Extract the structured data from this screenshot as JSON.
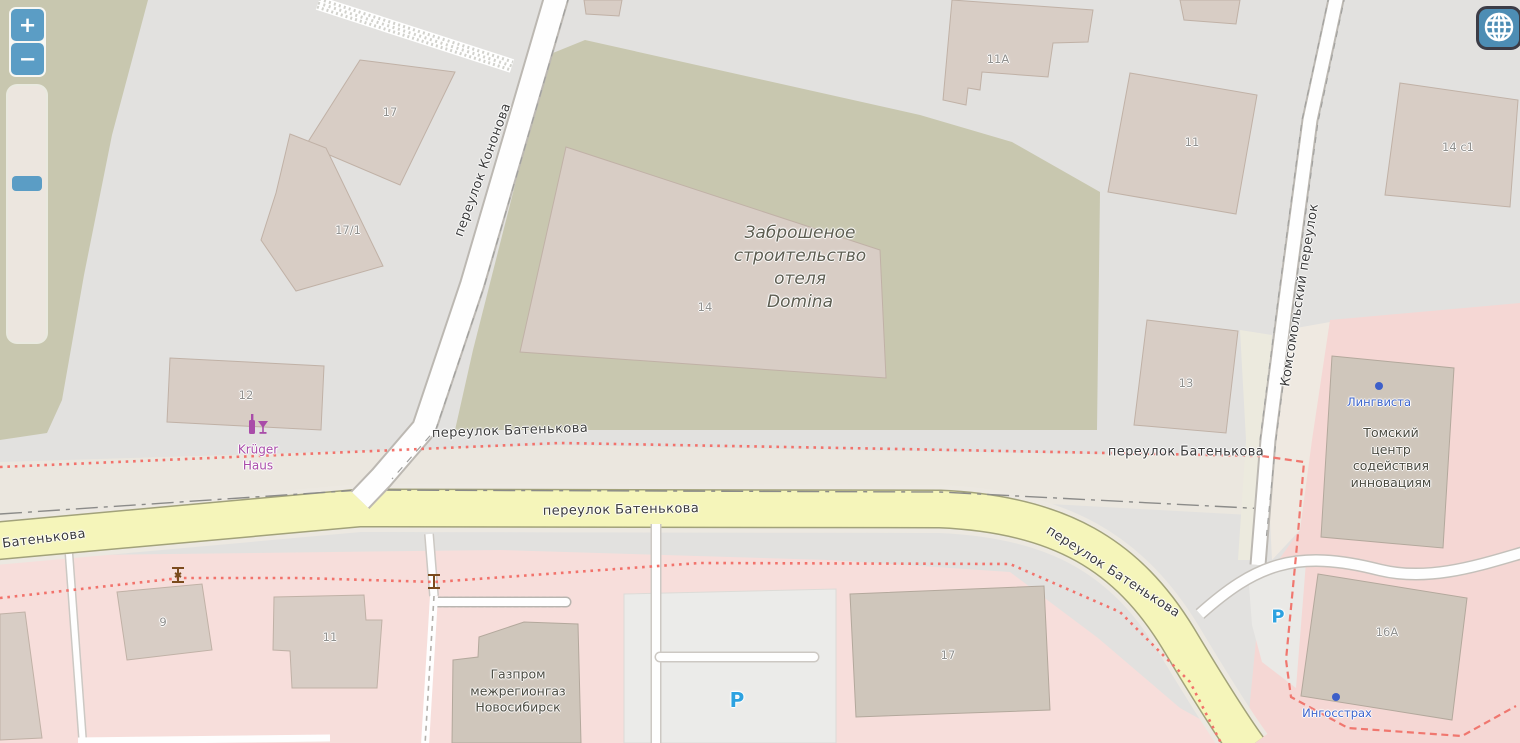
{
  "controls": {
    "zoom_in": "+",
    "zoom_out": "−"
  },
  "streets": {
    "kononova": "переулок Кононова",
    "komsomolsky": "Комсомольский переулок",
    "batenkova": "переулок Батенькова",
    "batenkova_short": "Батенькова"
  },
  "areas": {
    "abandoned": {
      "l1": "Заброшеное",
      "l2": "строительство",
      "l3": "отеля",
      "l4": "Domina"
    }
  },
  "buildings": {
    "b17_top": "17",
    "b17_1": "17/1",
    "b12": "12",
    "b14": "14",
    "b11a": "11A",
    "b11_top": "11",
    "b14c1": "14 c1",
    "b13": "13",
    "b16a": "16A",
    "b9": "9",
    "b11_bottom": "11",
    "b17_bottom": "17"
  },
  "pois": {
    "kruger": {
      "l1": "Krüger",
      "l2": "Haus"
    },
    "lingvista": "Лингвиста",
    "tomsk": {
      "l1": "Томский",
      "l2": "центр",
      "l3": "содействия",
      "l4": "инновациям"
    },
    "ingosstrakh": "Ингосстрах",
    "gazprom": {
      "l1": "Газпром",
      "l2": "межрегионгаз",
      "l3": "Новосибирск"
    },
    "parking": "P"
  },
  "colors": {
    "road_yellow": "#f5f5ba",
    "residential_pink": "#f7dedb",
    "scrub_green": "#c8c7af",
    "building_fill": "#d8cdc5",
    "path_red": "#f2726b",
    "poi_blue": "#3b63cc",
    "poi_purple": "#a94ca9",
    "parking_blue": "#2da2e0",
    "control_blue": "#5b9dc5"
  }
}
